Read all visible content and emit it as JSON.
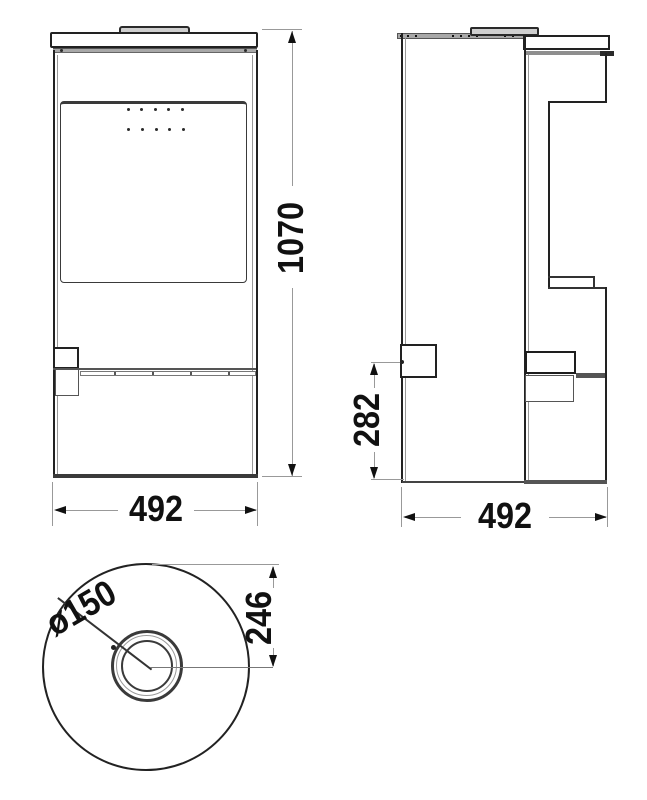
{
  "dimensions": {
    "front": {
      "height": "1070",
      "width": "492"
    },
    "side": {
      "depth": "492",
      "rear_outlet_height": "282"
    },
    "top": {
      "flue_diameter": "ø150",
      "flue_center_offset": "246"
    }
  },
  "colors": {
    "ink": "#222222",
    "dim_line": "#999999",
    "text": "#111111",
    "metal_fill": "#a8a8a8",
    "cap_fill": "#cfcfcf",
    "background": "#ffffff"
  }
}
